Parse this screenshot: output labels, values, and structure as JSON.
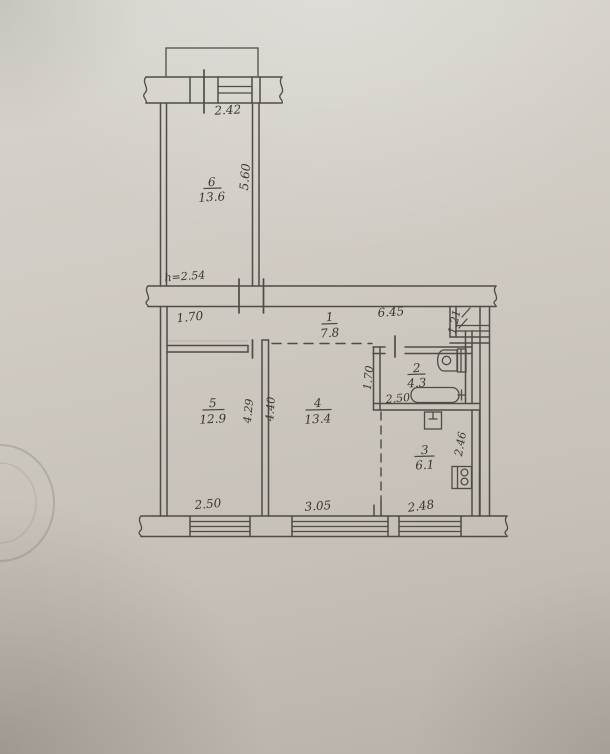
{
  "rooms": [
    {
      "id": "room-6",
      "number": "6",
      "area": "13.6"
    },
    {
      "id": "room-1",
      "number": "1",
      "area": "7.8"
    },
    {
      "id": "room-2",
      "number": "2",
      "area": "4.3"
    },
    {
      "id": "room-5",
      "number": "5",
      "area": "12.9"
    },
    {
      "id": "room-4",
      "number": "4",
      "area": "13.4"
    },
    {
      "id": "room-3",
      "number": "3",
      "area": "6.1"
    }
  ],
  "dimensions": {
    "balcony_window_width": "2.42",
    "room6_length": "5.60",
    "ceiling_height": "h=2.54",
    "hallway_left_width": "1.70",
    "hallway_length": "6.45",
    "niche_width": "1.21",
    "bathroom_depth": "1.70",
    "bathroom_width": "2.50",
    "room5_window_width": "2.50",
    "room5_depth": "4.29",
    "room4_depth": "4.40",
    "room4_window_width": "3.05",
    "kitchen_window_width": "2.48",
    "kitchen_depth": "2.46"
  },
  "colors": {
    "paper": "#cbc6be",
    "ink": "#45423c"
  }
}
